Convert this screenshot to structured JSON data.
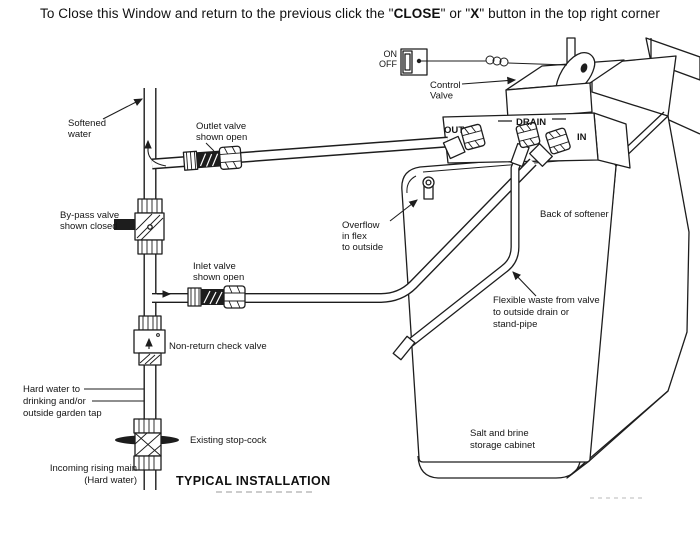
{
  "header": {
    "prefix": "To Close this Window and return to the previous click the \"",
    "bold1": "CLOSE",
    "mid": "\" or \"",
    "bold2": "X",
    "suffix": "\" button in the top right corner"
  },
  "colors": {
    "ink": "#1d1d1d",
    "background": "#ffffff"
  },
  "labels": {
    "on": "ON",
    "off": "OFF",
    "control_valve": [
      "Control",
      "Valve"
    ],
    "out": "OUT",
    "drain": "DRAIN",
    "in": "IN",
    "softened_water": [
      "Softened",
      "water"
    ],
    "outlet_valve": [
      "Outlet valve",
      "shown open"
    ],
    "bypass_valve": [
      "By-pass valve",
      "shown closed"
    ],
    "overflow": [
      "Overflow",
      "in flex",
      "to outside"
    ],
    "back_of_softener": "Back of softener",
    "inlet_valve": [
      "Inlet valve",
      "shown open"
    ],
    "flexible_waste": [
      "Flexible waste from valve",
      "to outside drain or",
      "stand-pipe"
    ],
    "non_return": "Non-return check valve",
    "hard_water": [
      "Hard water to",
      "drinking and/or",
      "outside garden tap"
    ],
    "existing_stopcock": "Existing stop-cock",
    "incoming_main": [
      "Incoming rising main",
      "(Hard water)"
    ],
    "salt_brine": [
      "Salt and brine",
      "storage cabinet"
    ],
    "title": "TYPICAL INSTALLATION"
  },
  "icons": {
    "flow_arrows": "black line arrows showing water flow direction",
    "switch": "rocker on/off switch"
  }
}
